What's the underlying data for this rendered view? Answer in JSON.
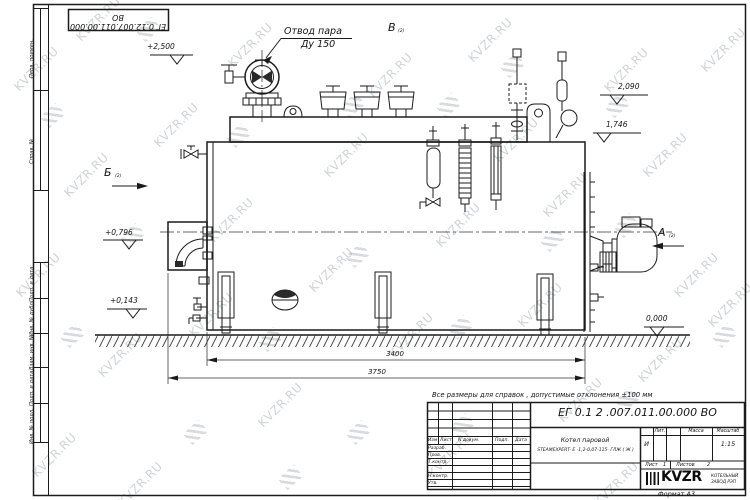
{
  "watermark": {
    "text": "KVZR.RU"
  },
  "sheet": {
    "designation_top": "ЕГ 0.12.007.011.00.000  ВО",
    "format": "Формат А3",
    "note": "Все размеры для справок , допустимые отклонения  ±100 мм"
  },
  "margin": {
    "perv": "Перв. примен.",
    "sprav": "Справ. №",
    "podp1": "Подп. и дата",
    "inv_dubl": "Инв. № дубл.",
    "vzam": "Взам. инв. №",
    "podp2": "Подп. и дата",
    "inv_podl": "Инв. № подл."
  },
  "drawing": {
    "steam1": "Отвод пара",
    "steam2": "Ду 150",
    "view_a": "А",
    "view_b": "Б",
    "view_v": "В",
    "view_ref": "(2)",
    "elev_2500": "+2,500",
    "elev_2090": "2,090",
    "elev_1746": "1,746",
    "elev_0796": "+0,796",
    "elev_0143": "+0,143",
    "elev_0000": "0,000",
    "dim_3400": "3400",
    "dim_3750": "3750"
  },
  "title_block": {
    "designation": "ЕГ 0.1 2 .007.011.00.000  ВО",
    "name1": "Котел паровой",
    "name2": "STEAMEXPERT- Е -1,2-0,07-115- ГЛЖ ( Ж )",
    "col_izm": "Изм",
    "col_list": "Лист",
    "col_ndoc": "N докум.",
    "col_podp": "Подп.",
    "col_data": "Дата",
    "row_razrab": "Разраб.",
    "row_prov": "Пров.",
    "row_tkontr": "Т.контр.",
    "row_nkontr": "Н.контр.",
    "row_utv": "Утв.",
    "lit_label": "Лит.",
    "mass_label": "Масса",
    "scale_label": "Масштаб",
    "lit_value": "И",
    "scale_value": "1:15",
    "list_label": "Лист",
    "list_value": "1",
    "listov_label": "Листов",
    "listov_value": "2",
    "brand": "KVZR",
    "brand_sub1": "КОТЕЛЬНЫЙ",
    "brand_sub2": "ЗАВОД РЭП"
  }
}
